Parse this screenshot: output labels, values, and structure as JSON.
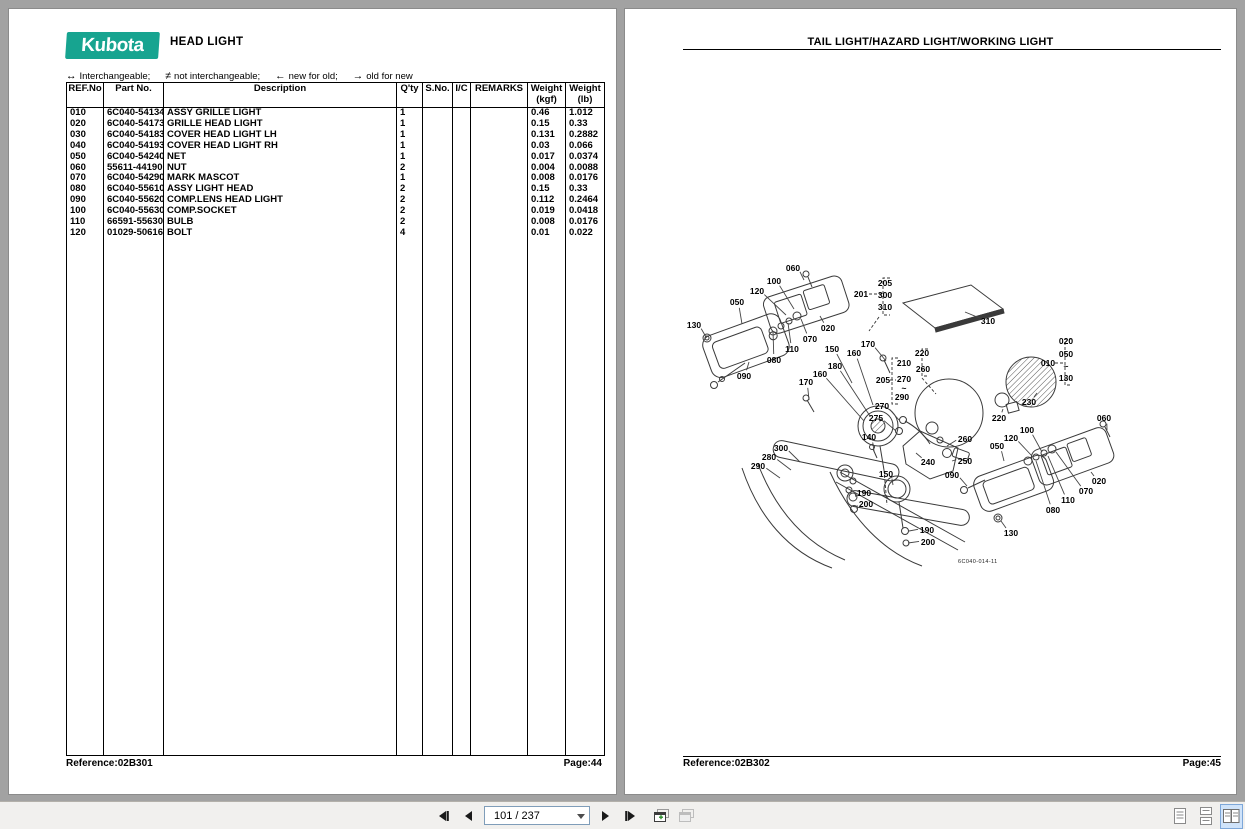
{
  "colors": {
    "logo_teal": "#17a490",
    "canvas_gray": "#a2a2a2",
    "selected_layout_bg": "#cfe3fa",
    "selected_layout_border": "#7da7d9"
  },
  "left_page": {
    "logo_text": "Kubota",
    "title": "HEAD LIGHT",
    "legend": [
      {
        "sym": "↔",
        "text": "Interchangeable;"
      },
      {
        "sym": "≠",
        "text": "not interchangeable;"
      },
      {
        "sym": "←",
        "text": "new for old;"
      },
      {
        "sym": "→",
        "text": "old for new"
      }
    ],
    "table": {
      "headers": [
        [
          "REF.No"
        ],
        [
          "Part No."
        ],
        [
          "Description"
        ],
        [
          "Q'ty"
        ],
        [
          "S.No."
        ],
        [
          "I/C"
        ],
        [
          "REMARKS"
        ],
        [
          "Weight",
          "(kgf)"
        ],
        [
          "Weight",
          "(lb)"
        ]
      ],
      "col_widths": [
        37,
        60,
        233,
        26,
        30,
        18,
        57,
        38,
        39
      ],
      "rows": [
        [
          "010",
          "6C040-54134",
          "ASSY GRILLE LIGHT",
          "1",
          "",
          "",
          "",
          "0.46",
          "1.012"
        ],
        [
          "020",
          "6C040-54173",
          "GRILLE HEAD LIGHT",
          "1",
          "",
          "",
          "",
          "0.15",
          "0.33"
        ],
        [
          "030",
          "6C040-54183",
          "COVER HEAD LIGHT LH",
          "1",
          "",
          "",
          "",
          "0.131",
          "0.2882"
        ],
        [
          "040",
          "6C040-54193",
          "COVER HEAD LIGHT RH",
          "1",
          "",
          "",
          "",
          "0.03",
          "0.066"
        ],
        [
          "050",
          "6C040-54240",
          "NET",
          "1",
          "",
          "",
          "",
          "0.017",
          "0.0374"
        ],
        [
          "060",
          "55611-44190",
          "NUT",
          "2",
          "",
          "",
          "",
          "0.004",
          "0.0088"
        ],
        [
          "070",
          "6C040-54290",
          "MARK MASCOT",
          "1",
          "",
          "",
          "",
          "0.008",
          "0.0176"
        ],
        [
          "080",
          "6C040-55610",
          "ASSY LIGHT HEAD",
          "2",
          "",
          "",
          "",
          "0.15",
          "0.33"
        ],
        [
          "090",
          "6C040-55620",
          "COMP.LENS HEAD LIGHT",
          "2",
          "",
          "",
          "",
          "0.112",
          "0.2464"
        ],
        [
          "100",
          "6C040-55630",
          "COMP.SOCKET",
          "2",
          "",
          "",
          "",
          "0.019",
          "0.0418"
        ],
        [
          "110",
          "66591-55630",
          "BULB",
          "2",
          "",
          "",
          "",
          "0.008",
          "0.0176"
        ],
        [
          "120",
          "01029-50616",
          "BOLT",
          "4",
          "",
          "",
          "",
          "0.01",
          "0.022"
        ]
      ]
    },
    "footer": {
      "reference": "Reference:02B301",
      "page": "Page:44"
    }
  },
  "right_page": {
    "title": "TAIL LIGHT/HAZARD LIGHT/WORKING LIGHT",
    "footer": {
      "reference": "Reference:02B302",
      "page": "Page:45"
    },
    "diagram": {
      "drawing_no": "6C040-014-11",
      "callouts": [
        {
          "t": "060",
          "x": 793,
          "y": 271,
          "ax": 804,
          "ay": 280
        },
        {
          "t": "100",
          "x": 774,
          "y": 284,
          "ax": 794,
          "ay": 309
        },
        {
          "t": "120",
          "x": 757,
          "y": 294,
          "ax": 786,
          "ay": 315
        },
        {
          "t": "050",
          "x": 737,
          "y": 305,
          "ax": 742,
          "ay": 324
        },
        {
          "t": "130",
          "x": 694,
          "y": 328,
          "ax": 706,
          "ay": 337
        },
        {
          "t": "020",
          "x": 828,
          "y": 331,
          "ax": 820,
          "ay": 316
        },
        {
          "t": "070",
          "x": 810,
          "y": 342,
          "ax": 801,
          "ay": 319
        },
        {
          "t": "110",
          "x": 792,
          "y": 352,
          "ax": 788,
          "ay": 323
        },
        {
          "t": "080",
          "x": 774,
          "y": 363,
          "ax": 773,
          "ay": 331
        },
        {
          "t": "090",
          "x": 744,
          "y": 379,
          "ax": 749,
          "ay": 362
        },
        {
          "t": "201",
          "x": 861,
          "y": 297
        },
        {
          "t": "205",
          "x": 885,
          "y": 286
        },
        {
          "t": "300",
          "x": 885,
          "y": 298
        },
        {
          "t": "310",
          "x": 885,
          "y": 310
        },
        {
          "t": "310",
          "x": 988,
          "y": 324,
          "ax": 965,
          "ay": 312
        },
        {
          "t": "170",
          "x": 868,
          "y": 347,
          "ax": 886,
          "ay": 361
        },
        {
          "t": "160",
          "x": 854,
          "y": 356,
          "ax": 873,
          "ay": 405
        },
        {
          "t": "150",
          "x": 832,
          "y": 352,
          "ax": 852,
          "ay": 383
        },
        {
          "t": "180",
          "x": 835,
          "y": 369,
          "ax": 870,
          "ay": 416
        },
        {
          "t": "160",
          "x": 820,
          "y": 377,
          "ax": 864,
          "ay": 421
        },
        {
          "t": "170",
          "x": 806,
          "y": 385,
          "ax": 809,
          "ay": 400
        },
        {
          "t": "220",
          "x": 922,
          "y": 356
        },
        {
          "t": "260",
          "x": 923,
          "y": 372
        },
        {
          "t": "210",
          "x": 904,
          "y": 366
        },
        {
          "t": "270",
          "x": 904,
          "y": 382
        },
        {
          "t": "~",
          "x": 904,
          "y": 391
        },
        {
          "t": "290",
          "x": 902,
          "y": 400
        },
        {
          "t": "205",
          "x": 883,
          "y": 383
        },
        {
          "t": "270",
          "x": 882,
          "y": 409,
          "ax": 899,
          "ay": 420
        },
        {
          "t": "275",
          "x": 876,
          "y": 421,
          "ax": 896,
          "ay": 431
        },
        {
          "t": "140",
          "x": 869,
          "y": 440,
          "ax": 874,
          "ay": 451
        },
        {
          "t": "300",
          "x": 781,
          "y": 451,
          "ax": 800,
          "ay": 462
        },
        {
          "t": "280",
          "x": 769,
          "y": 460,
          "ax": 791,
          "ay": 470
        },
        {
          "t": "290",
          "x": 758,
          "y": 469,
          "ax": 780,
          "ay": 478
        },
        {
          "t": "240",
          "x": 928,
          "y": 465,
          "ax": 916,
          "ay": 453
        },
        {
          "t": "260",
          "x": 965,
          "y": 442,
          "ax": 947,
          "ay": 446
        },
        {
          "t": "250",
          "x": 965,
          "y": 464,
          "ax": 952,
          "ay": 461
        },
        {
          "t": "150",
          "x": 886,
          "y": 477,
          "ax": 893,
          "ay": 485
        },
        {
          "t": "190",
          "x": 864,
          "y": 496,
          "ax": 856,
          "ay": 497
        },
        {
          "t": "200",
          "x": 866,
          "y": 507,
          "ax": 857,
          "ay": 509
        },
        {
          "t": "190",
          "x": 927,
          "y": 533,
          "ax": 909,
          "ay": 531
        },
        {
          "t": "200",
          "x": 928,
          "y": 545,
          "ax": 908,
          "ay": 543
        },
        {
          "t": "230",
          "x": 1029,
          "y": 405,
          "ax": 1037,
          "ay": 393
        },
        {
          "t": "220",
          "x": 999,
          "y": 421,
          "ax": 1003,
          "ay": 409
        },
        {
          "t": "010",
          "x": 1048,
          "y": 366
        },
        {
          "t": "020",
          "x": 1066,
          "y": 344
        },
        {
          "t": "050",
          "x": 1066,
          "y": 357
        },
        {
          "t": "~",
          "x": 1066,
          "y": 369
        },
        {
          "t": "130",
          "x": 1066,
          "y": 381
        },
        {
          "t": "060",
          "x": 1104,
          "y": 421,
          "ax": 1107,
          "ay": 430
        },
        {
          "t": "100",
          "x": 1027,
          "y": 433,
          "ax": 1042,
          "ay": 452
        },
        {
          "t": "120",
          "x": 1011,
          "y": 441,
          "ax": 1032,
          "ay": 456
        },
        {
          "t": "050",
          "x": 997,
          "y": 449,
          "ax": 1004,
          "ay": 461
        },
        {
          "t": "090",
          "x": 952,
          "y": 478,
          "ax": 967,
          "ay": 486
        },
        {
          "t": "020",
          "x": 1099,
          "y": 484,
          "ax": 1091,
          "ay": 472
        },
        {
          "t": "070",
          "x": 1086,
          "y": 494,
          "ax": 1056,
          "ay": 452
        },
        {
          "t": "110",
          "x": 1068,
          "y": 503,
          "ax": 1048,
          "ay": 456
        },
        {
          "t": "080",
          "x": 1053,
          "y": 513,
          "ax": 1036,
          "ay": 461
        },
        {
          "t": "130",
          "x": 1011,
          "y": 536,
          "ax": 1001,
          "ay": 521
        }
      ]
    }
  },
  "toolbar": {
    "page_indicator": "101 / 237"
  }
}
